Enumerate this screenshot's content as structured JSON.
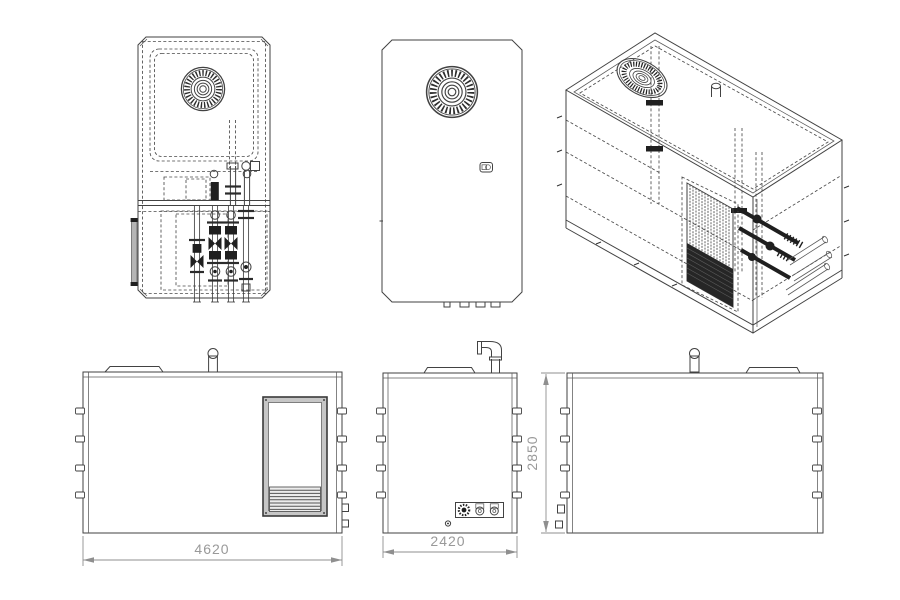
{
  "drawing": {
    "dimensions": {
      "overall_length": "4620",
      "overall_depth": "2420",
      "overall_height": "2850"
    },
    "colors": {
      "background": "#ffffff",
      "line": "#424242",
      "dark_fill": "#1f1f1f",
      "door_frame": "#c6c6c6",
      "hinge_bar": "#b5b5b5",
      "dimension_line": "#8f8f8f",
      "dimension_text": "#999999"
    },
    "views": [
      {
        "id": "top-view-detailed",
        "description": "plan view with fan and internal piping"
      },
      {
        "id": "top-view-panel",
        "description": "plan view of roof panel with fan and latch"
      },
      {
        "id": "isometric-view",
        "description": "3D wireframe view with condenser and valve manifold"
      },
      {
        "id": "side-elevation-left",
        "description": "side elevation with louvered access door"
      },
      {
        "id": "end-elevation",
        "description": "end elevation with flue elbow and service connections"
      },
      {
        "id": "side-elevation-right",
        "description": "opposite side elevation"
      }
    ]
  }
}
